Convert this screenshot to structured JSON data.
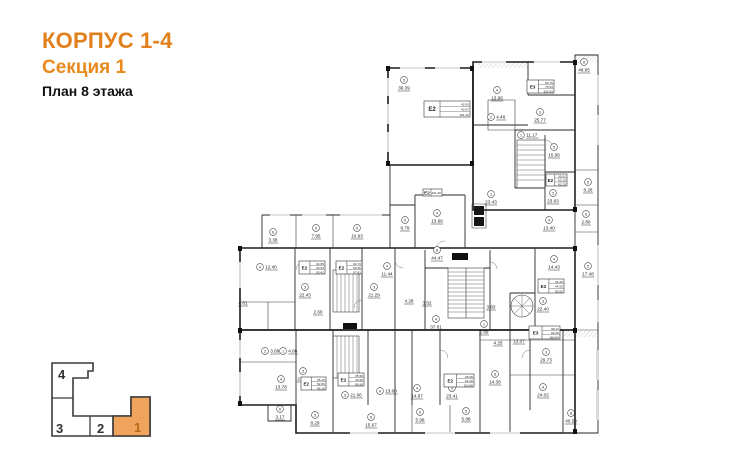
{
  "title": {
    "building": "КОРПУС 1-4",
    "section": "Секция 1",
    "floor": "План 8 этажа"
  },
  "keyplan": {
    "sections": [
      {
        "label": "4",
        "active": false
      },
      {
        "label": "3",
        "active": false
      },
      {
        "label": "2",
        "active": false
      },
      {
        "label": "1",
        "active": true
      }
    ],
    "active_color": "#f0a35c"
  },
  "plan": {
    "ink": "#1c1c1c",
    "rooms": [
      {
        "i": "5",
        "a": "36.39",
        "x": 404,
        "y": 80
      },
      {
        "i": "4",
        "a": "13.96",
        "x": 497,
        "y": 90
      },
      {
        "i": "8",
        "a": "48.65",
        "x": 584,
        "y": 62
      },
      {
        "i": "3",
        "a": "25.77",
        "x": 540,
        "y": 112
      },
      {
        "i": "2",
        "a": "4.48",
        "x": 491,
        "y": 117,
        "d": "r"
      },
      {
        "i": "1",
        "a": "11.17",
        "x": 521,
        "y": 135,
        "d": "r"
      },
      {
        "i": "5",
        "a": "15.96",
        "x": 554,
        "y": 147
      },
      {
        "i": "5",
        "a": "8.28",
        "x": 588,
        "y": 182
      },
      {
        "i": "3",
        "a": "23.63",
        "x": 553,
        "y": 193
      },
      {
        "i": "6",
        "a": "2.80",
        "x": 586,
        "y": 214
      },
      {
        "i": "4",
        "a": "13.40",
        "x": 549,
        "y": 220
      },
      {
        "i": "5",
        "a": "6.79",
        "x": 405,
        "y": 220
      },
      {
        "i": "4",
        "a": "13.66",
        "x": 437,
        "y": 213
      },
      {
        "i": "1",
        "a": "23.43",
        "x": 491,
        "y": 194
      },
      {
        "i": "6",
        "a": "3.38",
        "x": 273,
        "y": 232
      },
      {
        "i": "5",
        "a": "7.95",
        "x": 316,
        "y": 228
      },
      {
        "i": "5",
        "a": "10.93",
        "x": 357,
        "y": 228
      },
      {
        "i": "4",
        "a": "12.40",
        "x": 260,
        "y": 267,
        "d": "r"
      },
      {
        "i": "3",
        "a": "22.43",
        "x": 305,
        "y": 287
      },
      {
        "i": "3",
        "a": "21.29",
        "x": 374,
        "y": 287
      },
      {
        "i": "4",
        "a": "11.44",
        "x": 387,
        "y": 266
      },
      {
        "i": "",
        "a": "4.61",
        "x": 243,
        "y": 295
      },
      {
        "i": "",
        "a": "2.60",
        "x": 318,
        "y": 304
      },
      {
        "i": "",
        "a": "4.28",
        "x": 409,
        "y": 293
      },
      {
        "i": "",
        "a": "3.52",
        "x": 427,
        "y": 295
      },
      {
        "i": "8",
        "a": "44.47",
        "x": 437,
        "y": 250
      },
      {
        "i": "",
        "a": "3.83",
        "x": 491,
        "y": 299
      },
      {
        "i": "3",
        "a": "22.40",
        "x": 543,
        "y": 301
      },
      {
        "i": "5",
        "a": "17.48",
        "x": 588,
        "y": 266
      },
      {
        "i": "4",
        "a": "14.43",
        "x": 554,
        "y": 259
      },
      {
        "i": "4",
        "a": "37.81",
        "x": 436,
        "y": 319
      },
      {
        "i": "1",
        "a": "2.89",
        "x": 484,
        "y": 324
      },
      {
        "i": "",
        "a": "4.25",
        "x": 498,
        "y": 335
      },
      {
        "i": "",
        "a": "13.07",
        "x": 519,
        "y": 333
      },
      {
        "i": "3",
        "a": "29.73",
        "x": 546,
        "y": 352
      },
      {
        "i": "4",
        "a": "24.02",
        "x": 543,
        "y": 387
      },
      {
        "i": "4",
        "a": "14.87",
        "x": 417,
        "y": 388
      },
      {
        "i": "3",
        "a": "23.41",
        "x": 452,
        "y": 388
      },
      {
        "i": "5",
        "a": "14.38",
        "x": 495,
        "y": 374
      },
      {
        "i": "4",
        "a": "13.78",
        "x": 281,
        "y": 379
      },
      {
        "i": "3",
        "a": "21.32",
        "x": 303,
        "y": 371
      },
      {
        "i": "3",
        "a": "21.66",
        "x": 345,
        "y": 395,
        "d": "r"
      },
      {
        "i": "4",
        "a": "13.60",
        "x": 380,
        "y": 391,
        "d": "r"
      },
      {
        "i": "2",
        "a": "3.08",
        "x": 265,
        "y": 351,
        "d": "r"
      },
      {
        "i": "1",
        "a": "4.06",
        "x": 283,
        "y": 351,
        "d": "r"
      },
      {
        "i": "6",
        "a": "3.17",
        "x": 280,
        "y": 409
      },
      {
        "i": "5",
        "a": "8.29",
        "x": 315,
        "y": 415
      },
      {
        "i": "5",
        "a": "15.67",
        "x": 371,
        "y": 417
      },
      {
        "i": "6",
        "a": "5.98",
        "x": 420,
        "y": 412
      },
      {
        "i": "5",
        "a": "5.98",
        "x": 466,
        "y": 411
      },
      {
        "i": "8",
        "a": "40.50",
        "x": 571,
        "y": 413
      }
    ],
    "unit_tags": [
      {
        "t": "Е2",
        "rows": [
          "42.00",
          "43.67",
          "101.40"
        ],
        "x": 424,
        "y": 101,
        "w": 46,
        "h": 16,
        "big": true
      },
      {
        "t": "Е3",
        "rows": [
          "50.75",
          "75.93",
          "101.63"
        ],
        "x": 527,
        "y": 80,
        "w": 27,
        "h": 13
      },
      {
        "t": "Е2",
        "rows": [
          "35.01",
          "50.10",
          "93.15"
        ],
        "x": 546,
        "y": 174,
        "w": 21,
        "h": 12
      },
      {
        "t": "Е2",
        "rows": [
          "34.65",
          "43.94",
          "93.41"
        ],
        "x": 299,
        "y": 261,
        "w": 26,
        "h": 13
      },
      {
        "t": "Е2",
        "rows": [
          "34.73",
          "50.38",
          "97.83"
        ],
        "x": 336,
        "y": 261,
        "w": 26,
        "h": 13
      },
      {
        "t": "Е2",
        "rows": [
          "34.28",
          "44.55",
          "90.52"
        ],
        "x": 538,
        "y": 279,
        "w": 26,
        "h": 14
      },
      {
        "t": "Е2",
        "rows": [
          "35.15",
          "52.86",
          "95.10"
        ],
        "x": 301,
        "y": 377,
        "w": 25,
        "h": 13
      },
      {
        "t": "Е2",
        "rows": [
          "35.96",
          "43.96",
          "96.96"
        ],
        "x": 338,
        "y": 373,
        "w": 26,
        "h": 13
      },
      {
        "t": "Е2",
        "rows": [
          "28.26",
          "61.26",
          "110.66"
        ],
        "x": 444,
        "y": 374,
        "w": 30,
        "h": 13
      },
      {
        "t": "Е3",
        "rows": [
          "68.11",
          "92.26",
          "160.84"
        ],
        "x": 529,
        "y": 326,
        "w": 31,
        "h": 13
      },
      {
        "t": "Е2",
        "rows": [
          "101.40"
        ],
        "x": 423,
        "y": 189,
        "w": 19,
        "h": 7
      }
    ],
    "badges": [
      {
        "x": 452,
        "y": 253,
        "w": 16,
        "h": 7
      },
      {
        "x": 343,
        "y": 323,
        "w": 14,
        "h": 6
      }
    ]
  }
}
